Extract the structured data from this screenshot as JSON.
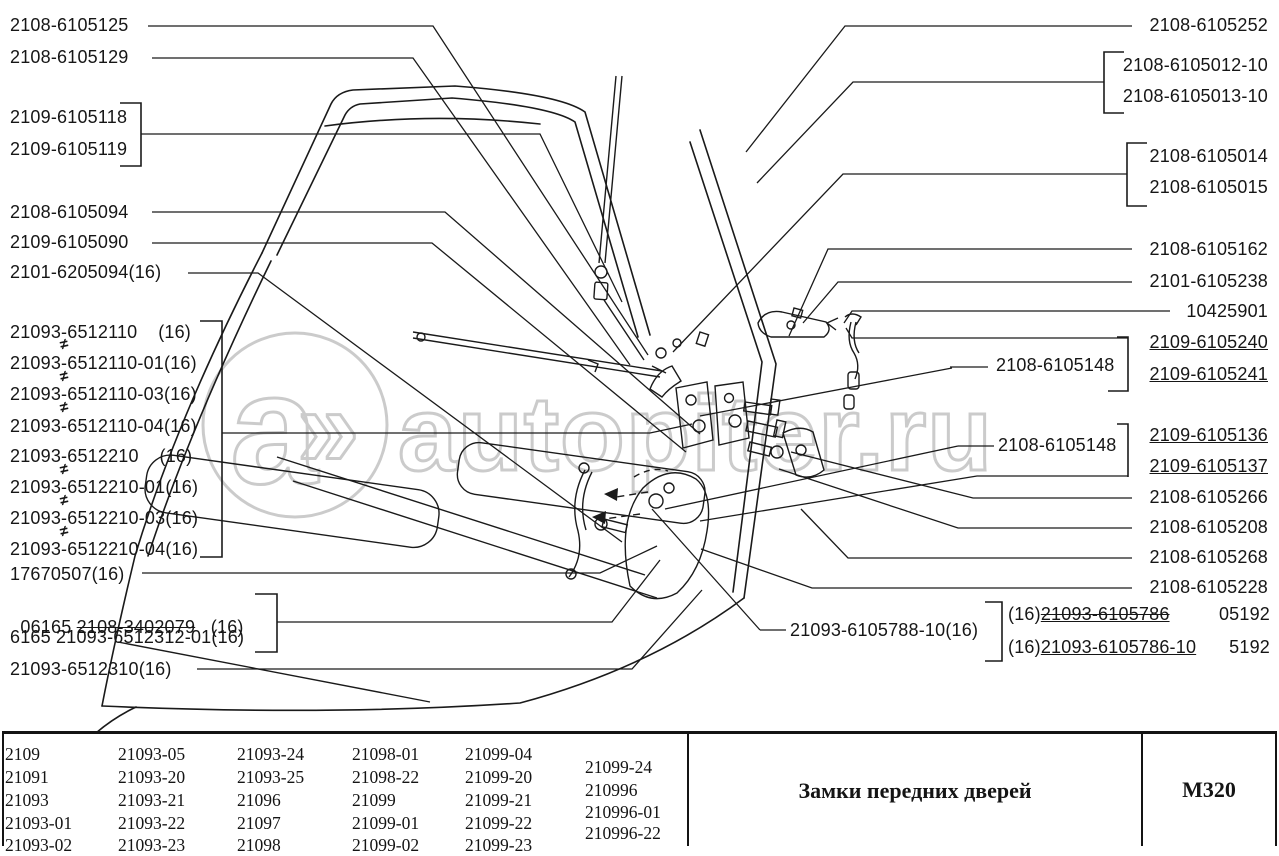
{
  "diagram": {
    "watermark": {
      "logo_letter": "a",
      "logo_arrow": "»",
      "site": "autopiter.ru",
      "color": "#cbcbcb"
    },
    "symbols": {
      "neq": "≠"
    },
    "labels_left": [
      {
        "text": "2108-6105125"
      },
      {
        "text": "2108-6105129"
      },
      {
        "text": "2109-6105118"
      },
      {
        "text": "2109-6105119"
      },
      {
        "text": "2108-6105094"
      },
      {
        "text": "2109-6105090"
      },
      {
        "text": "2101-6205094(16)"
      },
      {
        "text": "21093-6512110    (16)"
      },
      {
        "text": "21093-6512110-01(16)"
      },
      {
        "text": "21093-6512110-03(16)"
      },
      {
        "text": "21093-6512110-04(16)"
      },
      {
        "text": "21093-6512210    (16)"
      },
      {
        "text": "21093-6512210-01(16)"
      },
      {
        "text": "21093-6512210-03(16)"
      },
      {
        "text": "21093-6512210-04(16)"
      },
      {
        "text": "17670507(16)"
      },
      {
        "prefix": "06165 ",
        "struck": "2108-3402079",
        "suffix": "   (16)"
      },
      {
        "text": "6165 21093-6512312-01(16)"
      },
      {
        "text": "21093-6512310(16)"
      }
    ],
    "labels_right": [
      {
        "text": "2108-6105252"
      },
      {
        "text": "2108-6105012-10"
      },
      {
        "text": "2108-6105013-10"
      },
      {
        "text": "2108-6105014"
      },
      {
        "text": "2108-6105015"
      },
      {
        "text": "2108-6105162"
      },
      {
        "text": "2101-6105238"
      },
      {
        "text": "10425901"
      },
      {
        "text": "2109-6105240"
      },
      {
        "text": "2109-6105241"
      },
      {
        "text": "2109-6105136"
      },
      {
        "text": "2109-6105137"
      },
      {
        "text": "2108-6105266"
      },
      {
        "text": "2108-6105208"
      },
      {
        "text": "2108-6105268"
      },
      {
        "text": "2108-6105228"
      },
      {
        "prefix": "(16)",
        "part": "21093-6105786",
        "code": "05192"
      },
      {
        "prefix": "(16)",
        "part": "21093-6105786-10",
        "code": "5192"
      }
    ],
    "labels_center": [
      {
        "text": "2108-6105148"
      },
      {
        "text": "2108-6105148"
      },
      {
        "text": "21093-6105788-10(16)"
      }
    ]
  },
  "footer_table": {
    "models": [
      [
        "2109",
        "21091",
        "21093",
        "21093-01",
        "21093-02"
      ],
      [
        "21093-05",
        "21093-20",
        "21093-21",
        "21093-22",
        "21093-23"
      ],
      [
        "21093-24",
        "21093-25",
        "21096",
        "21097",
        "21098"
      ],
      [
        "21098-01",
        "21098-22",
        "21099",
        "21099-01",
        "21099-02"
      ],
      [
        "21099-04",
        "21099-20",
        "21099-21",
        "21099-22",
        "21099-23"
      ],
      [
        "21099-24",
        "210996",
        "210996-01",
        "210996-22"
      ]
    ],
    "title": "Замки передних дверей",
    "sheet_code": "М320"
  }
}
